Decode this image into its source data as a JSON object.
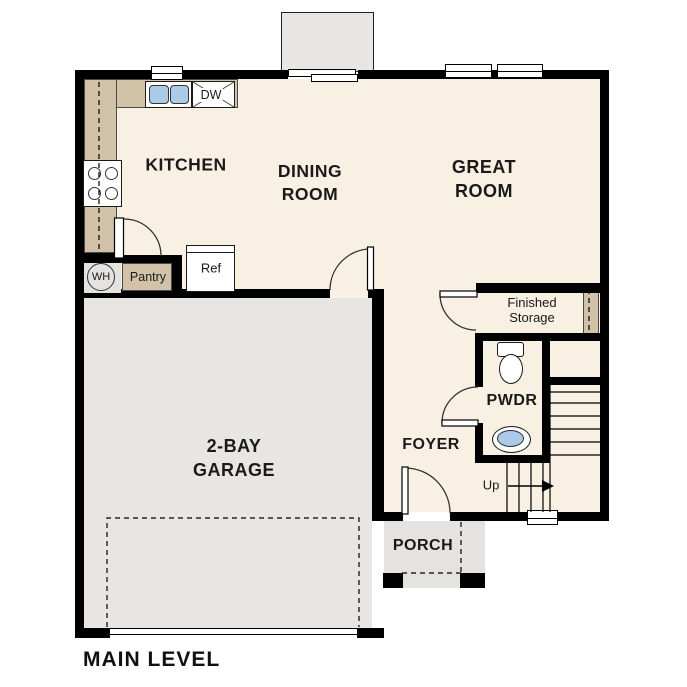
{
  "plan_title": "MAIN LEVEL",
  "rooms": {
    "kitchen": "KITCHEN",
    "dining_room": [
      "DINING",
      "ROOM"
    ],
    "great_room": [
      "GREAT",
      "ROOM"
    ],
    "garage": [
      "2-BAY",
      "GARAGE"
    ],
    "foyer": "FOYER",
    "powder_room": "PWDR",
    "porch": "PORCH",
    "finished_storage": [
      "Finished",
      "Storage"
    ]
  },
  "labels": {
    "water_heater": "WH",
    "pantry": "Pantry",
    "refrigerator": "Ref",
    "dishwasher": "DW",
    "stairs_up": "Up"
  },
  "colors": {
    "floor": "#f8f0e2",
    "garage-floor": "#e7e6e3",
    "porch-floor": "#e4e3e0",
    "counter": "#d2c3a8",
    "fixture-blue": "#aacae8",
    "wall": "#000000",
    "ink": "#1a1a1a"
  }
}
